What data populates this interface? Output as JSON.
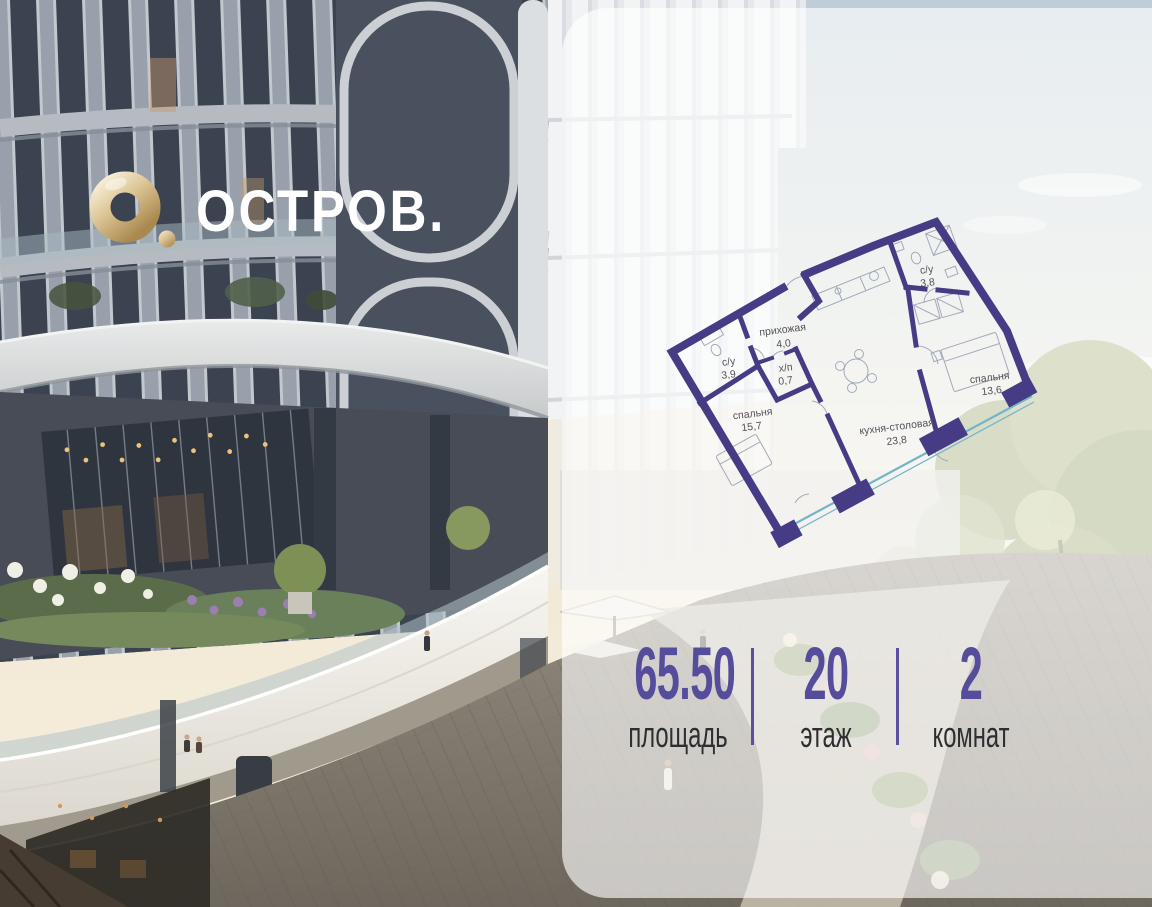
{
  "logo": {
    "brand": "ОСТРОВ."
  },
  "floor_plan": {
    "rooms": [
      {
        "name": "прихожая",
        "area": "4,0"
      },
      {
        "name": "с/у",
        "area": "3,9"
      },
      {
        "name": "х/п",
        "area": "0,7"
      },
      {
        "name": "спальня",
        "area": "15,7"
      },
      {
        "name": "с/у",
        "area": "3,8"
      },
      {
        "name": "спальня",
        "area": "13,6"
      },
      {
        "name": "кухня-столовая",
        "area": "23,8"
      }
    ]
  },
  "stats": {
    "items": [
      {
        "value": "65.50",
        "label": "площадь"
      },
      {
        "value": "20",
        "label": "этаж"
      },
      {
        "value": "2",
        "label": "комнат"
      }
    ]
  },
  "colors": {
    "accent_purple": "#564c9c",
    "plan_wall": "#453c85",
    "plan_glazing": "#72b4ca",
    "logo_gold": "#d3b887",
    "panel_tint": "rgba(255,255,255,0.63)"
  }
}
